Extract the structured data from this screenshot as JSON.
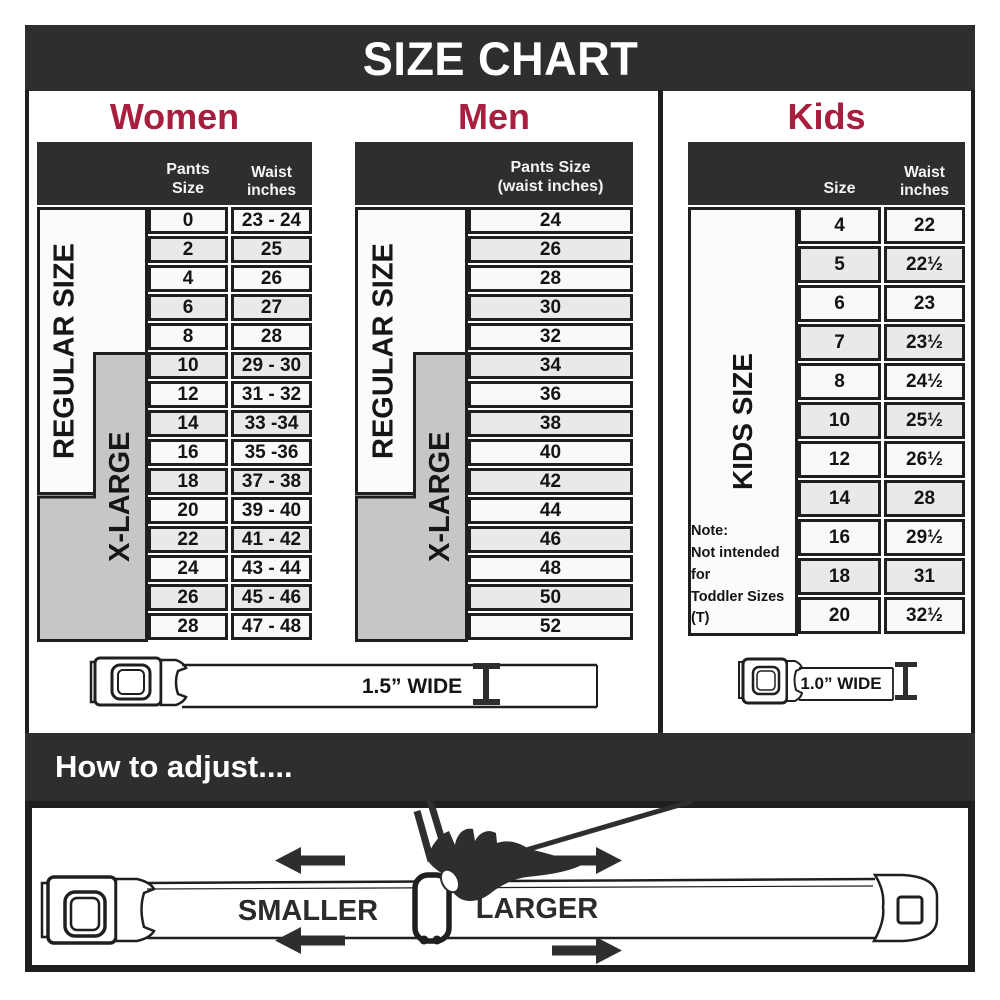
{
  "title": "SIZE CHART",
  "sections": {
    "women": {
      "heading": "Women",
      "col_headers": {
        "pants": "Pants Size",
        "waist": "Waist\ninches"
      },
      "side_labels": {
        "regular": "REGULAR SIZE",
        "xlarge": "X-LARGE"
      },
      "rows": [
        [
          "0",
          "23 - 24"
        ],
        [
          "2",
          "25"
        ],
        [
          "4",
          "26"
        ],
        [
          "6",
          "27"
        ],
        [
          "8",
          "28"
        ],
        [
          "10",
          "29 - 30"
        ],
        [
          "12",
          "31 - 32"
        ],
        [
          "14",
          "33 -34"
        ],
        [
          "16",
          "35 -36"
        ],
        [
          "18",
          "37 - 38"
        ],
        [
          "20",
          "39 - 40"
        ],
        [
          "22",
          "41 - 42"
        ],
        [
          "24",
          "43 - 44"
        ],
        [
          "26",
          "45 - 46"
        ],
        [
          "28",
          "47 - 48"
        ]
      ]
    },
    "men": {
      "heading": "Men",
      "col_headers": {
        "pants": "Pants Size\n(waist inches)"
      },
      "side_labels": {
        "regular": "REGULAR SIZE",
        "xlarge": "X-LARGE"
      },
      "rows": [
        "24",
        "26",
        "28",
        "30",
        "32",
        "34",
        "36",
        "38",
        "40",
        "42",
        "44",
        "46",
        "48",
        "50",
        "52"
      ]
    },
    "kids": {
      "heading": "Kids",
      "col_headers": {
        "size": "Size",
        "waist": "Waist\ninches"
      },
      "side_labels": {
        "kids": "KIDS SIZE"
      },
      "rows": [
        [
          "4",
          "22"
        ],
        [
          "5",
          "22½"
        ],
        [
          "6",
          "23"
        ],
        [
          "7",
          "23½"
        ],
        [
          "8",
          "24½"
        ],
        [
          "10",
          "25½"
        ],
        [
          "12",
          "26½"
        ],
        [
          "14",
          "28"
        ],
        [
          "16",
          "29½"
        ],
        [
          "18",
          "31"
        ],
        [
          "20",
          "32½"
        ]
      ],
      "note": "Note:\nNot intended for\nToddler Sizes (T)"
    }
  },
  "belts": {
    "adult_width_label": "1.5” WIDE",
    "kids_width_label": "1.0” WIDE"
  },
  "adjust": {
    "heading": "How to adjust....",
    "smaller_label": "SMALLER",
    "larger_label": "LARGER"
  },
  "colors": {
    "banner_dark": "#2e2e2e",
    "accent_red": "#a81e3e",
    "xlarge_gray": "#c6c6c6",
    "ink": "#1f1f1f"
  }
}
